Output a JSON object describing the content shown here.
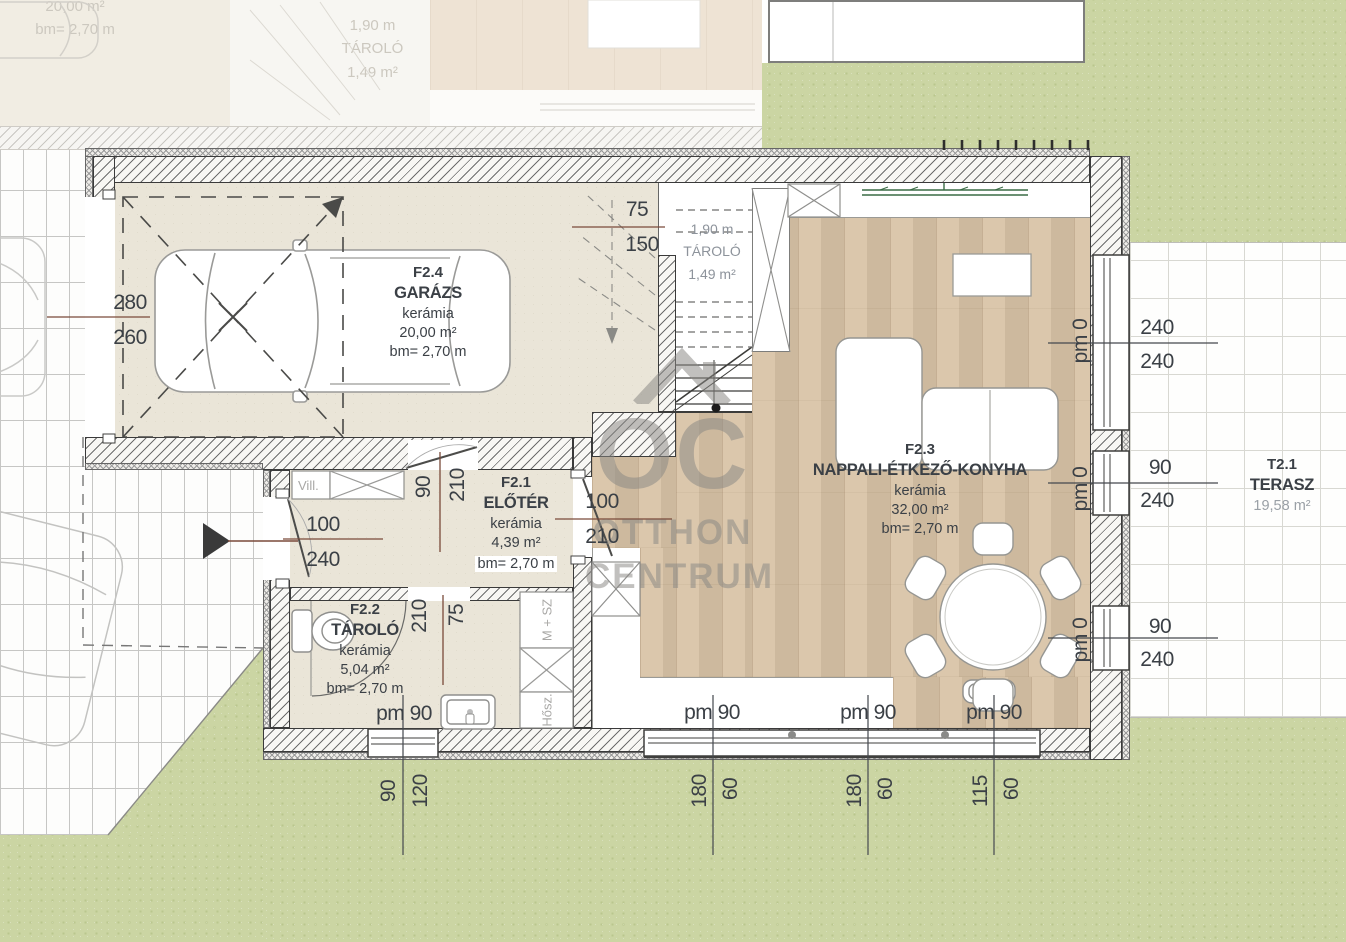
{
  "watermark": {
    "logo": "OC",
    "word1": "OTTHON",
    "word2": "CENTRUM"
  },
  "rooms": {
    "garage": {
      "id": "F2.4",
      "name": "GARÁZS",
      "finish": "kerámia",
      "area": "20,00 m²",
      "height": "bm= 2,70 m"
    },
    "entry": {
      "id": "F2.1",
      "name": "ELŐTÉR",
      "finish": "kerámia",
      "area": "4,39 m²",
      "height": "bm= 2,70 m"
    },
    "storage": {
      "id": "F2.2",
      "name": "TÁROLÓ",
      "finish": "kerámia",
      "area": "5,04 m²",
      "height": "bm= 2,70 m"
    },
    "living": {
      "id": "F2.3",
      "name": "NAPPALI-ÉTKEZŐ-KONYHA",
      "finish": "kerámia",
      "area": "32,00 m²",
      "height": "bm= 2,70 m"
    },
    "terrace": {
      "id": "T2.1",
      "name": "TERASZ",
      "area": "19,58 m²"
    },
    "stair_storage": {
      "height": "1,90 m",
      "name": "TÁROLÓ",
      "area": "1,49 m²"
    }
  },
  "neighbor": {
    "garage_area": "20,00 m²",
    "garage_height": "bm= 2,70 m",
    "storage_height": "1,90 m",
    "storage_name": "TÁROLÓ",
    "storage_area": "1,49 m²"
  },
  "fixtures": {
    "electrical": "Vill.",
    "washer_dryer": "M + SZ",
    "heating": "Hősz."
  },
  "dimensions": [
    {
      "t": "280",
      "x": 130,
      "y": 303
    },
    {
      "t": "260",
      "x": 130,
      "y": 338
    },
    {
      "t": "75",
      "x": 637,
      "y": 210
    },
    {
      "t": "150",
      "x": 642,
      "y": 245
    },
    {
      "t": "100",
      "x": 323,
      "y": 525
    },
    {
      "t": "240",
      "x": 323,
      "y": 560
    },
    {
      "t": "90",
      "x": 424,
      "y": 487,
      "rot": 1
    },
    {
      "t": "210",
      "x": 458,
      "y": 485,
      "rot": 1
    },
    {
      "t": "100",
      "x": 602,
      "y": 502
    },
    {
      "t": "210",
      "x": 602,
      "y": 537
    },
    {
      "t": "210",
      "x": 420,
      "y": 616,
      "rot": 1
    },
    {
      "t": "75",
      "x": 457,
      "y": 615,
      "rot": 1
    },
    {
      "t": "240",
      "x": 1157,
      "y": 328
    },
    {
      "t": "240",
      "x": 1157,
      "y": 362
    },
    {
      "t": "90",
      "x": 1160,
      "y": 468
    },
    {
      "t": "240",
      "x": 1157,
      "y": 501
    },
    {
      "t": "90",
      "x": 1160,
      "y": 627
    },
    {
      "t": "240",
      "x": 1157,
      "y": 660
    },
    {
      "t": "pm 0",
      "x": 1081,
      "y": 341,
      "rot": 1
    },
    {
      "t": "pm 0",
      "x": 1081,
      "y": 489,
      "rot": 1
    },
    {
      "t": "pm 0",
      "x": 1081,
      "y": 640,
      "rot": 1
    },
    {
      "t": "pm 90",
      "x": 404,
      "y": 714
    },
    {
      "t": "pm 90",
      "x": 712,
      "y": 713
    },
    {
      "t": "pm 90",
      "x": 868,
      "y": 713
    },
    {
      "t": "pm 90",
      "x": 994,
      "y": 713
    },
    {
      "t": "90",
      "x": 389,
      "y": 791,
      "rot": 1
    },
    {
      "t": "120",
      "x": 421,
      "y": 791,
      "rot": 1
    },
    {
      "t": "180",
      "x": 700,
      "y": 791,
      "rot": 1
    },
    {
      "t": "60",
      "x": 731,
      "y": 789,
      "rot": 1
    },
    {
      "t": "180",
      "x": 855,
      "y": 791,
      "rot": 1
    },
    {
      "t": "60",
      "x": 886,
      "y": 789,
      "rot": 1
    },
    {
      "t": "115",
      "x": 981,
      "y": 791,
      "rot": 1
    },
    {
      "t": "60",
      "x": 1012,
      "y": 789,
      "rot": 1
    }
  ],
  "colors": {
    "wood": "#d8c3a6",
    "tile": "#eae5d8",
    "grass": "#cbd5a3",
    "dim_text": "#3b4046",
    "dim_line_accent": "#7a4a3a",
    "watermark": "#8a8884",
    "shelf_green": "#3a6b45"
  }
}
